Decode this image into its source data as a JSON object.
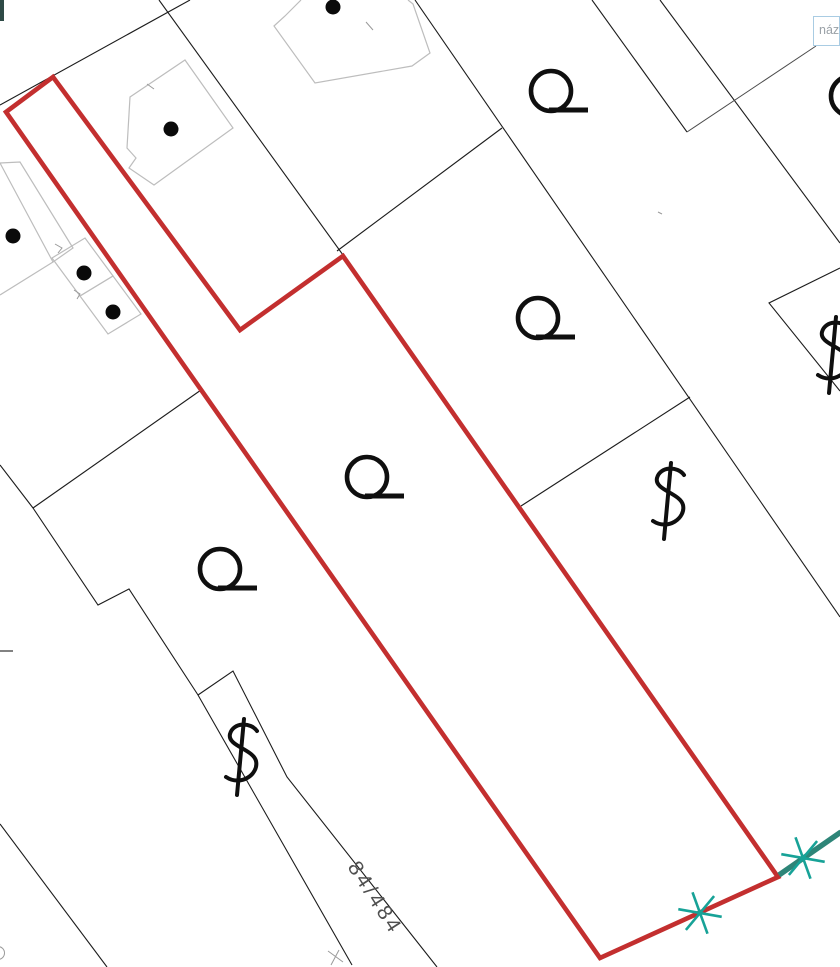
{
  "map": {
    "type": "cadastral-parcel-map",
    "tooltip": {
      "text": "náz"
    },
    "labels": {
      "parcel_number": "84/484"
    },
    "colors": {
      "highlighted_parcel_outline": "#c32f2f",
      "surveyed_boundary": "#2e8578",
      "survey_marker": "#17a297",
      "parcel_boundary": "#1c1c1c",
      "building_outline": "#bdbdbd",
      "background": "#ffffff"
    },
    "highlighted_parcel": {
      "outline_points": [
        [
          6,
          112
        ],
        [
          53,
          77
        ],
        [
          240,
          330
        ],
        [
          343,
          256
        ],
        [
          778,
          877
        ],
        [
          600,
          958
        ]
      ]
    },
    "land_use_symbols": {
      "orchard_circle_tail_positions": [
        {
          "x": 551,
          "y": 91
        },
        {
          "x": 538,
          "y": 318
        },
        {
          "x": 367,
          "y": 477
        },
        {
          "x": 220,
          "y": 569
        },
        {
          "x": 851,
          "y": 96
        }
      ],
      "garden_dollar_positions": [
        {
          "x": 668,
          "y": 501
        },
        {
          "x": 833,
          "y": 355
        },
        {
          "x": 241,
          "y": 757
        }
      ]
    },
    "building_points": [
      {
        "x": 333,
        "y": 7
      },
      {
        "x": 171,
        "y": 129
      },
      {
        "x": 13,
        "y": 236
      },
      {
        "x": 84,
        "y": 273
      },
      {
        "x": 113,
        "y": 312
      }
    ],
    "survey_markers": [
      {
        "x": 803,
        "y": 858
      },
      {
        "x": 700,
        "y": 913
      }
    ]
  }
}
